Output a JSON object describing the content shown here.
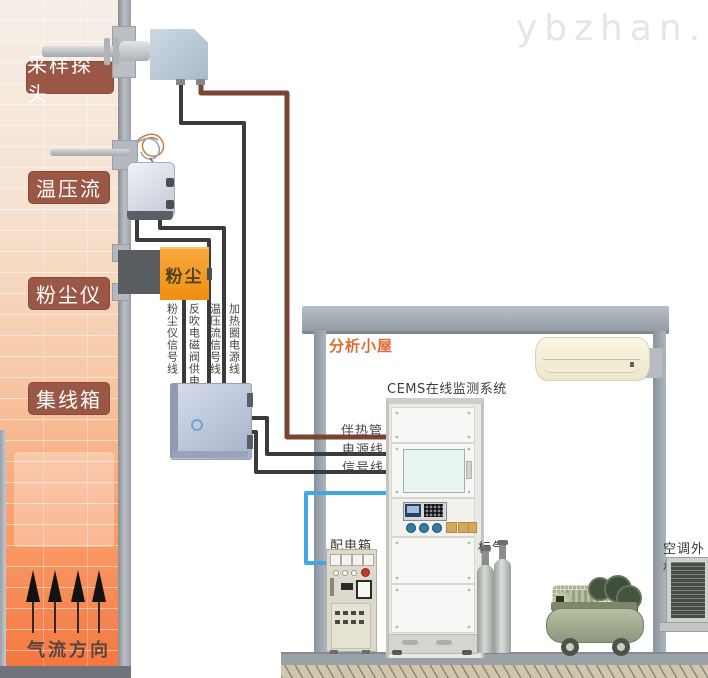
{
  "watermark": "ybzhan.cn",
  "stack": {
    "side_labels": [
      "采样探头",
      "温压流",
      "粉尘仪",
      "集线箱"
    ],
    "flow_direction_label": "气流方向",
    "dust_meter_text": "粉尘"
  },
  "cables": {
    "vertical_labels": [
      "粉尘仪信号线",
      "反吹电磁阀供电线",
      "温压流信号线",
      "加热圈电源线"
    ],
    "tube_label": "伴热管",
    "power_label": "电源线",
    "signal_label": "信号线"
  },
  "shed": {
    "title": "分析小屋",
    "cems_label": "CEMS在线监测系统",
    "distribution_box_label": "配电箱",
    "standard_gas_label": "标气",
    "ac_outdoor_label": "空调外机"
  },
  "colors": {
    "label_badge_bg": "#9b5745",
    "stack_wall_band": "#9aa0a6",
    "hot_gas_orange": "#f5733d",
    "cable_black": "#3b3b3b",
    "cable_brown": "#7c4335",
    "cable_blue": "#42a6e6",
    "shed_frame_gray": "#98a1a9",
    "shed_title_text": "#e06a35",
    "dust_meter_orange": "#f39c1f",
    "junction_box_blue": "#b9c4d8"
  }
}
